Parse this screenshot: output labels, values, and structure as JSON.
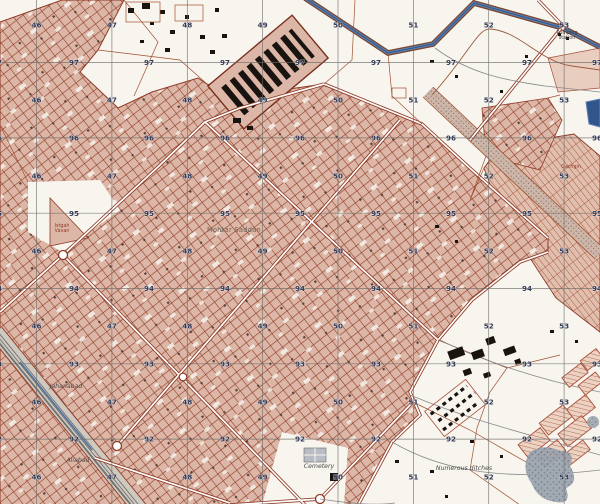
{
  "map": {
    "title": "topographic-city-map",
    "colors": {
      "paper": "#f8f5ef",
      "urban_fill": "#dcb6a6",
      "street": "#8e3b26",
      "grid_line": "#6a6a66",
      "grid_number": "#333a58",
      "water": "#5d82b4",
      "water_dark": "#31568c",
      "stipple": "#8a8a8a",
      "marsh": "#97a0ac"
    },
    "grid": {
      "eastings": [
        {
          "value": "46",
          "x": 36.5
        },
        {
          "value": "47",
          "x": 111.9
        },
        {
          "value": "48",
          "x": 187.3
        },
        {
          "value": "49",
          "x": 262.6
        },
        {
          "value": "50",
          "x": 338.0
        },
        {
          "value": "51",
          "x": 413.4
        },
        {
          "value": "52",
          "x": 488.7
        },
        {
          "value": "53",
          "x": 564.1
        }
      ],
      "northings": [
        {
          "value": "97",
          "y": 62.6
        },
        {
          "value": "96",
          "y": 137.9
        },
        {
          "value": "95",
          "y": 213.2
        },
        {
          "value": "94",
          "y": 288.5
        },
        {
          "value": "93",
          "y": 363.8
        },
        {
          "value": "92",
          "y": 439.1
        }
      ],
      "easting_label_rows": [
        25,
        100,
        176,
        251,
        326,
        402,
        477
      ],
      "northing_label_cols": [
        -3,
        74,
        149,
        225,
        300,
        376,
        451,
        527,
        597
      ]
    },
    "labels": [
      {
        "text": "Mohtar Saddan",
        "x": 234,
        "y": 232,
        "style": "place"
      },
      {
        "text": "Cemetery",
        "x": 319,
        "y": 468,
        "style": "italic"
      },
      {
        "text": "Numerous ditches",
        "x": 464,
        "y": 470,
        "style": "italic"
      },
      {
        "text": "Pumping",
        "x": 567,
        "y": 34,
        "style": "tiny"
      },
      {
        "text": "station",
        "x": 567,
        "y": 39,
        "style": "tiny"
      },
      {
        "text": "Gachgin",
        "x": 571,
        "y": 168,
        "style": "tiny-red"
      },
      {
        "text": "Istgah",
        "x": 62,
        "y": 227,
        "style": "tiny-red"
      },
      {
        "text": "Vavan",
        "x": 62,
        "y": 232,
        "style": "tiny-red"
      },
      {
        "text": "Jahanabad",
        "x": 66,
        "y": 388,
        "style": "italic"
      },
      {
        "text": "Aliabad",
        "x": 78,
        "y": 462,
        "style": "italic"
      }
    ]
  }
}
